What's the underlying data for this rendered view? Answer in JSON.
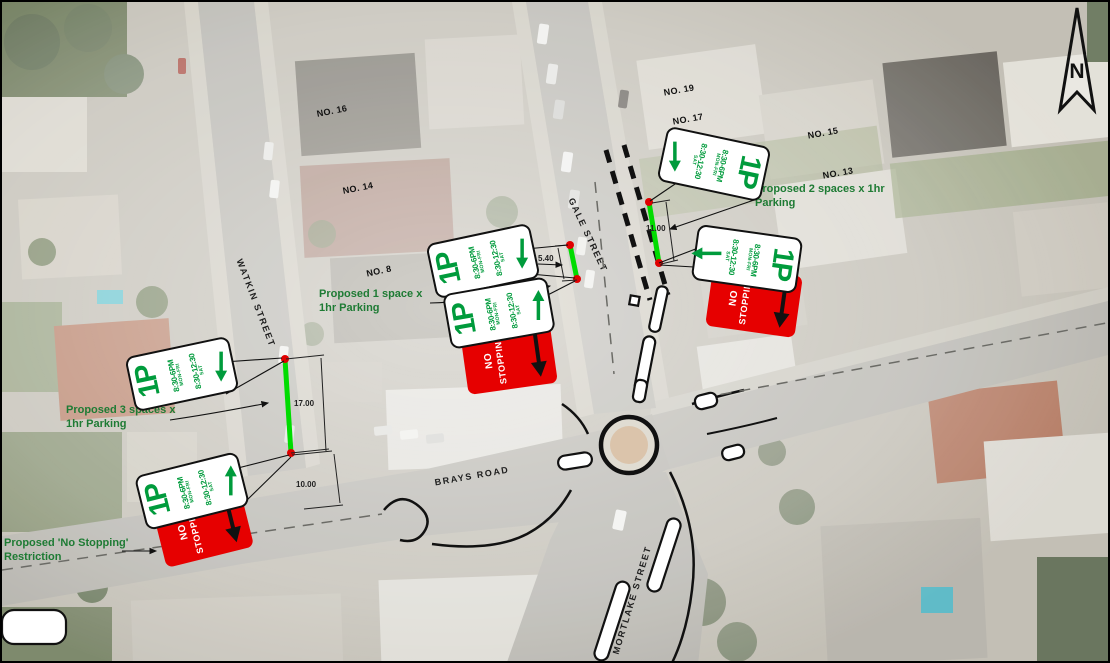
{
  "plan": {
    "north_label": "N",
    "streets": {
      "watkin": "WATKIN STREET",
      "gale": "GALE STREET",
      "brays": "BRAYS ROAD",
      "mortlake": "MORTLAKE STREET"
    },
    "house_numbers": [
      "NO. 16",
      "NO. 14",
      "NO. 8",
      "NO. 19",
      "NO. 17",
      "NO. 15",
      "NO. 13"
    ],
    "annotations": {
      "three_spaces": "Proposed 3 spaces x 1hr Parking",
      "no_stopping": "Proposed 'No Stopping' Restriction",
      "one_space": "Proposed 1 space x 1hr Parking",
      "two_spaces": "Proposed 2 spaces x 1hr Parking"
    },
    "dimensions": {
      "watkin_parking": "17.00",
      "watkin_gap": "10.00",
      "gale_west": "5.40",
      "gale_east": "11.00"
    },
    "signs": {
      "one_p": {
        "title": "1P",
        "period1": "8:30-6PM",
        "period1_days": "MON-FRI",
        "period2": "8:30-12:30",
        "period2_days": "SAT"
      },
      "no_stopping": {
        "word1": "NO",
        "word2": "STOPPING"
      }
    },
    "colors": {
      "parking_line_green": "#00DC00",
      "sign_green": "#009B3C",
      "annotation_green": "#1E7B34",
      "no_stopping_red": "#E60000",
      "endpoint_red": "#E00000"
    }
  }
}
